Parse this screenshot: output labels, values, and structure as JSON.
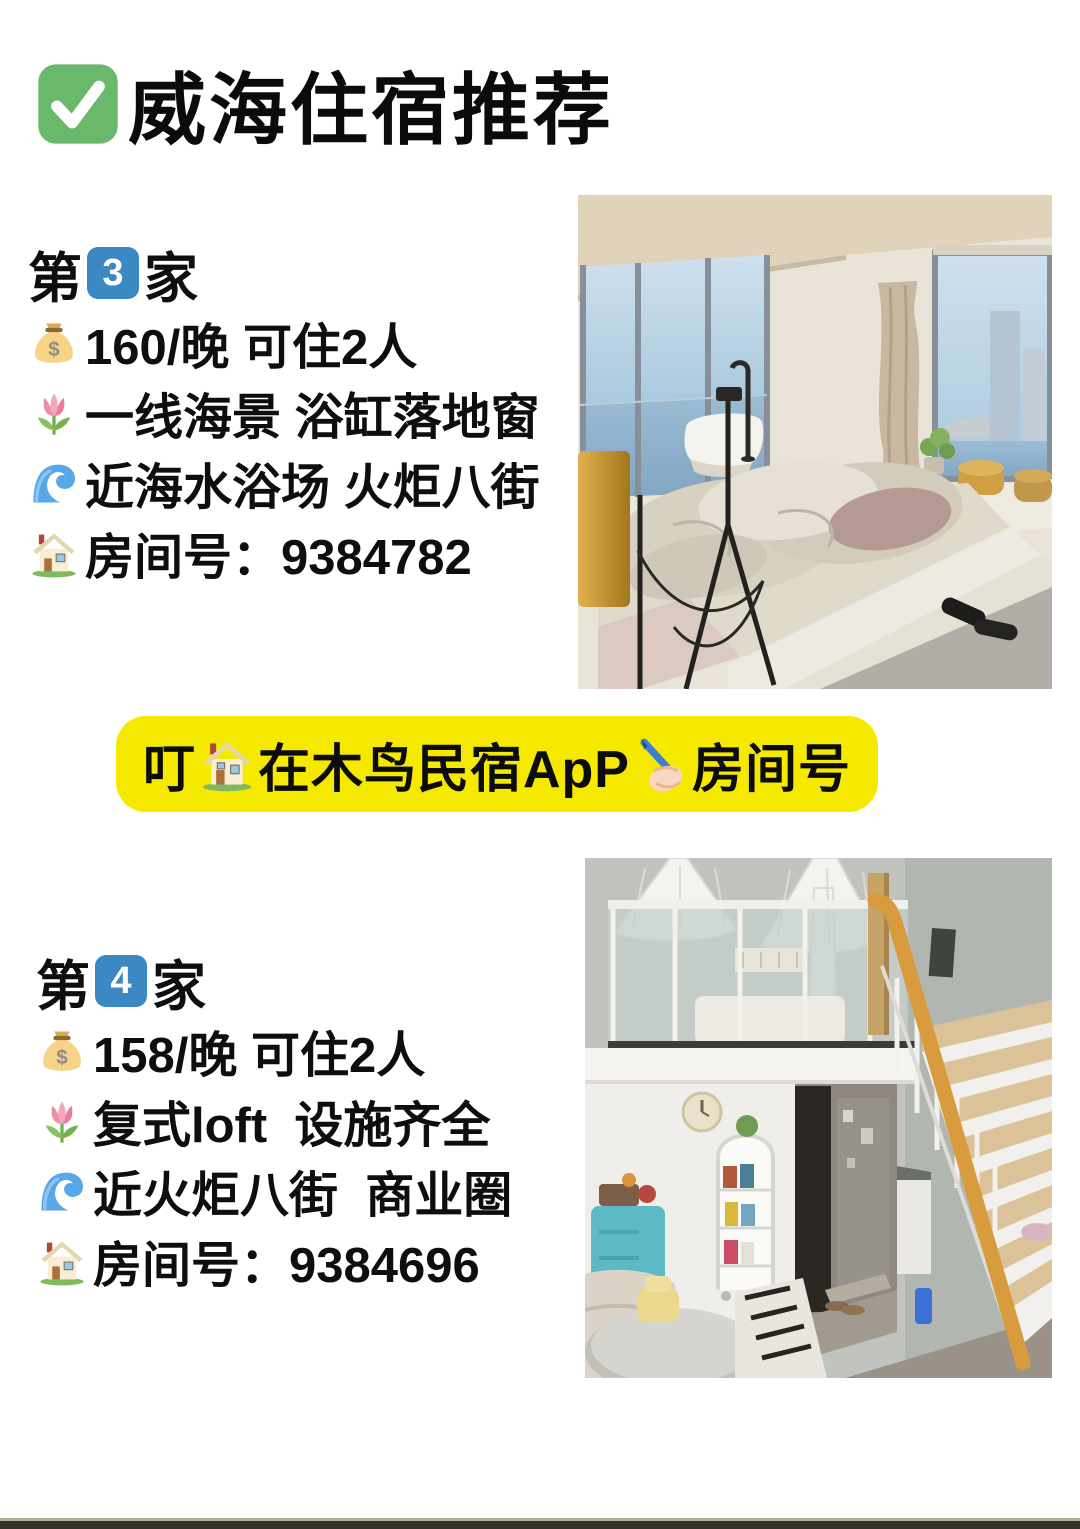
{
  "header": {
    "check_icon": "✅",
    "title": "威海住宿推荐"
  },
  "listings": [
    {
      "heading_prefix": "第",
      "heading_number": "3",
      "heading_suffix": "家",
      "lines": [
        {
          "icon": "💰 money-bag",
          "text": "160/晚 可住2人"
        },
        {
          "icon": "🌷 tulip",
          "text": "一线海景 浴缸落地窗"
        },
        {
          "icon": "🌊 wave",
          "text": "近海水浴场 火炬八街"
        },
        {
          "icon": "🏡 house",
          "text": "房间号：9384782"
        }
      ],
      "photo_alt": "海景大床房：落地窗、浴缸、海与城市天际线、黄色坐墩、拖鞋"
    },
    {
      "heading_prefix": "第",
      "heading_number": "4",
      "heading_suffix": "家",
      "lines": [
        {
          "icon": "💰 money-bag",
          "text": "158/晚 可住2人"
        },
        {
          "icon": "🌷 tulip",
          "text": "复式loft  设施齐全"
        },
        {
          "icon": "🌊 wave",
          "text": "近火炬八街  商业圈"
        },
        {
          "icon": "🏡 house",
          "text": "房间号：9384696"
        }
      ],
      "photo_alt": "复式loft：玻璃围栏阁楼、纱幔、挂钟、置物车、木楼梯黄扶手"
    }
  ],
  "banner": {
    "part1": "叮",
    "house_icon": "🏡",
    "part2": "在木鸟民宿ApP",
    "pen_icon": "✍️",
    "part3": "房间号"
  },
  "icons": {
    "dollar_symbol": "$"
  },
  "colors": {
    "banner_yellow": "#f6e900",
    "keycap_blue": "#3b88c3",
    "check_green": "#69b86b",
    "text_black": "#0e0e0e",
    "bottom_bar": "#32312c"
  }
}
